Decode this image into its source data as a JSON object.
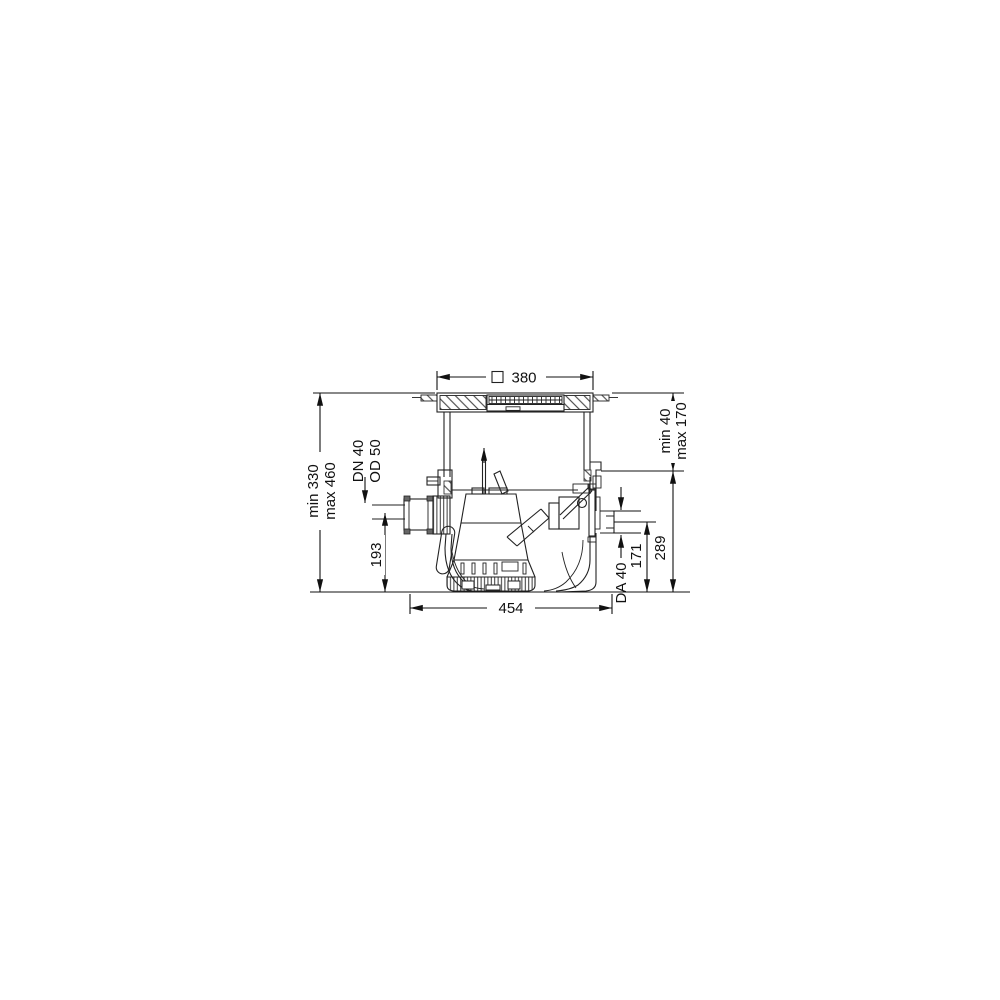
{
  "drawing": {
    "title": "pump-station-sectional-dimension-drawing",
    "dimensions": {
      "top_width": "380",
      "height_range": {
        "line1": "min 330",
        "line2": "max 460"
      },
      "inlet_connection": {
        "line1": "DN 40",
        "line2": "OD 50"
      },
      "inlet_height": "193",
      "overall_width": "454",
      "cover_adjust_range": {
        "line1": "min 40",
        "line2": "max 170"
      },
      "body_height": "289",
      "outlet_height": "171",
      "outlet_diameter": "DA 40"
    },
    "colors": {
      "line": "#222222",
      "text": "#111111",
      "background": "#ffffff"
    }
  }
}
